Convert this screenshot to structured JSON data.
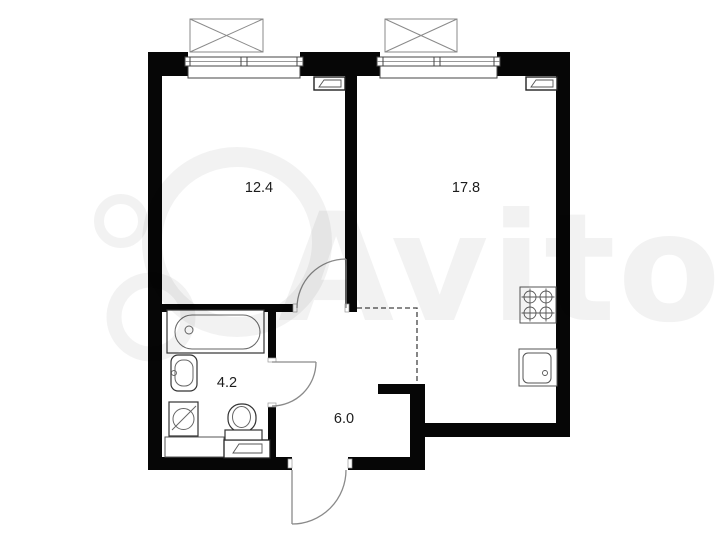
{
  "title": "Apartment floor plan",
  "watermark": {
    "text": "Avito"
  },
  "rooms": [
    {
      "name": "living-room",
      "area": "12.4"
    },
    {
      "name": "kitchen-living-room",
      "area": "17.8"
    },
    {
      "name": "bathroom",
      "area": "4.2"
    },
    {
      "name": "hallway",
      "area": "6.0"
    }
  ],
  "fixtures": [
    "window",
    "window",
    "ac-unit",
    "ac-unit",
    "vent-duct",
    "vent-duct",
    "vent-duct",
    "bathtub",
    "washbasin",
    "washing-machine",
    "toilet",
    "counter",
    "stove",
    "kitchen-sink",
    "interior-door",
    "interior-door",
    "entrance-door"
  ],
  "colors": {
    "wall": "#060606",
    "fixture_line": "#555555",
    "door_line": "#8a8a8a",
    "background": "#ffffff",
    "label_text": "#1c1c1c",
    "watermark": "rgba(0,0,0,0.05)"
  }
}
